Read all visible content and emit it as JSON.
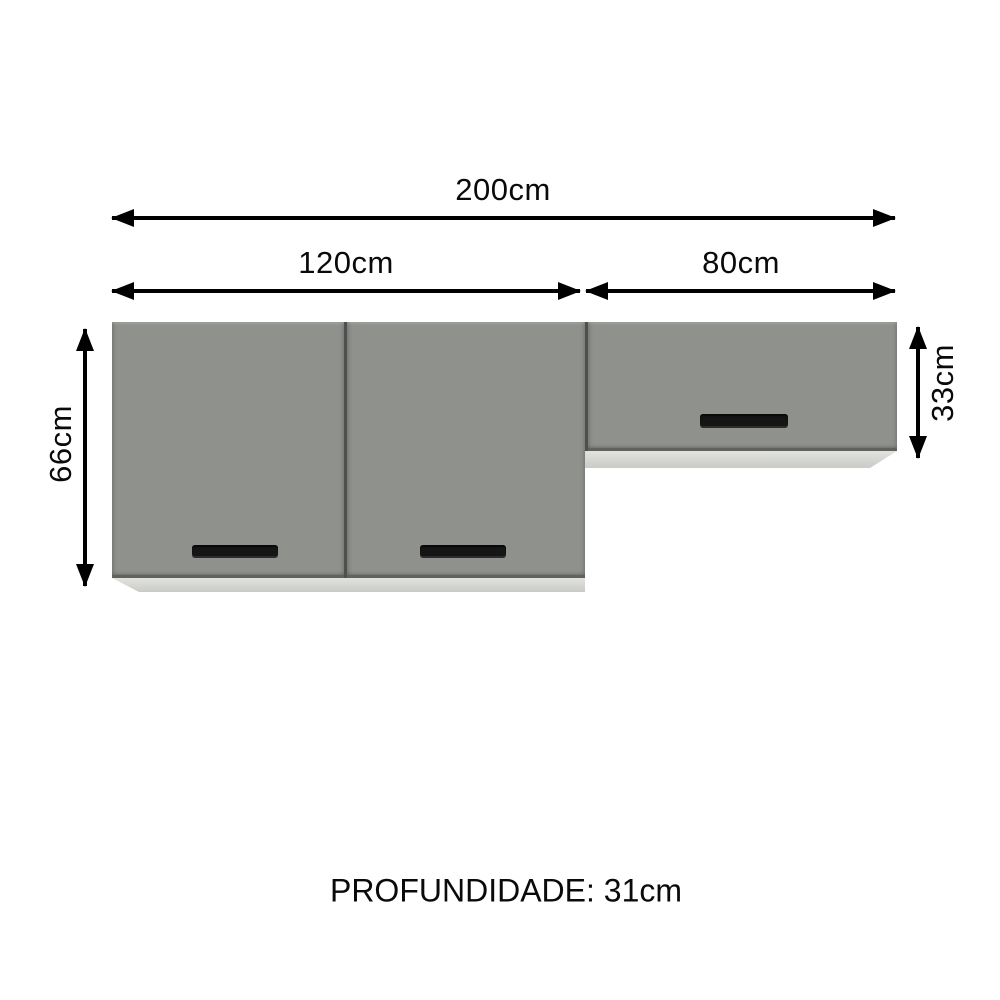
{
  "diagram": {
    "type": "furniture-dimension-diagram",
    "product": "wall kitchen cabinet set, 2 units, 3 doors",
    "labels": {
      "total_width": "200cm",
      "left_cabinet_width": "120cm",
      "right_cabinet_width": "80cm",
      "left_cabinet_height": "66cm",
      "right_cabinet_height": "33cm",
      "depth": "PROFUNDIDADE: 31cm"
    },
    "colors": {
      "background": "#ffffff",
      "door_gray": "#8f918d",
      "cabinet_body_light": "#d6d7d3",
      "handle_black": "#151515",
      "arrow_black": "#000000"
    },
    "structure": {
      "left_cabinet_doors": 2,
      "right_cabinet_doors": 1,
      "handles_per_door": 1
    }
  }
}
